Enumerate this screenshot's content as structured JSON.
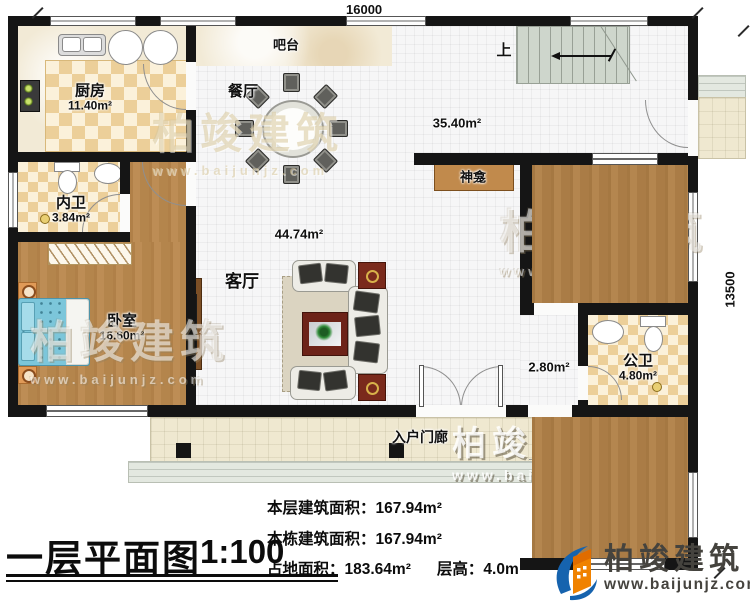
{
  "dimensions": {
    "width_label": "16000",
    "height_label": "13500"
  },
  "rooms": {
    "kitchen": {
      "name": "厨房",
      "area": "11.40m²"
    },
    "bar": {
      "name": "吧台"
    },
    "dining": {
      "name": "餐厅"
    },
    "hall": {
      "area": "35.40m²"
    },
    "stairs": {
      "label": "上"
    },
    "shrine": {
      "name": "神龛"
    },
    "ensuite": {
      "name": "内卫",
      "area": "3.84m²"
    },
    "bedroom_left": {
      "name": "卧室",
      "area": "16.60m²"
    },
    "living": {
      "name": "客厅",
      "area": "44.74m²"
    },
    "bedroom_top": {
      "name": "卧室",
      "area": "12.92m²"
    },
    "public_bath": {
      "name": "公卫",
      "area": "4.80m²"
    },
    "hallway": {
      "area": "2.80m²"
    },
    "bedroom_bottom": {
      "name": "卧室",
      "area": "16.34m²"
    },
    "porch": {
      "name": "入户门廊"
    }
  },
  "footer": {
    "title": "一层平面图",
    "scale": "1:100",
    "stats": [
      {
        "label": "本层建筑面积：",
        "value": "167.94m²"
      },
      {
        "label": "本栋建筑面积：",
        "value": "167.94m²"
      },
      {
        "label": "占地面积：",
        "value": "183.64m²"
      },
      {
        "label": "层高：",
        "value": "4.0m"
      }
    ]
  },
  "branding": {
    "name": "柏竣建筑",
    "url": "www.baijunjz.com"
  }
}
